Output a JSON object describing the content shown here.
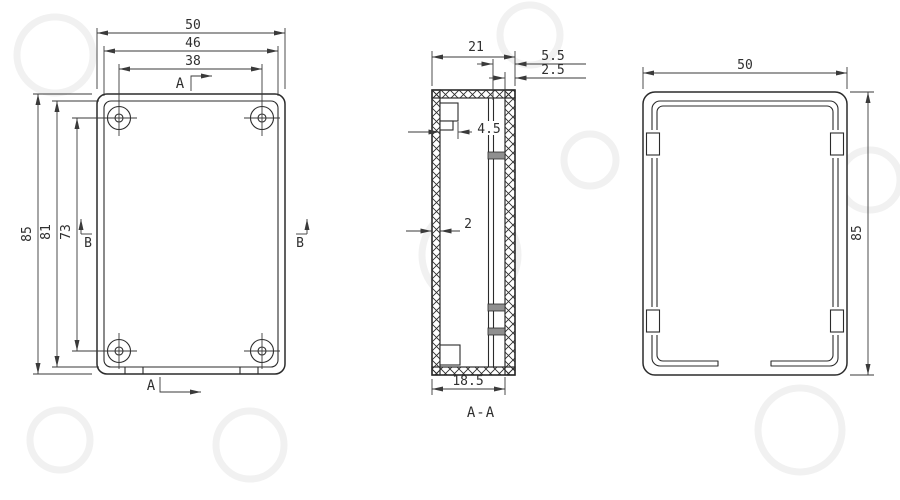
{
  "front_view": {
    "dim_width_outer": "50",
    "dim_width_inner": "46",
    "dim_hole_span_h": "38",
    "dim_height_outer": "85",
    "dim_height_inner": "81",
    "dim_hole_span_v": "73",
    "cut_label_top": "A",
    "cut_label_bottom": "A",
    "cut_label_left": "B",
    "cut_label_right": "B"
  },
  "section_view": {
    "title": "A-A",
    "dim_depth": "21",
    "dim_lid_inset": "5.5",
    "dim_wall_right": "2.5",
    "dim_boss": "4.5",
    "dim_wall_left": "2",
    "dim_inner_depth": "18.5"
  },
  "side_view": {
    "dim_width": "50",
    "dim_height": "85"
  },
  "colors": {
    "line": "#2b2b2b",
    "dim": "#3a3a3a",
    "text": "#2f2f2f",
    "tab_fill": "#8f8f8f",
    "background": "#ffffff",
    "watermark": "#f1f1f1"
  }
}
